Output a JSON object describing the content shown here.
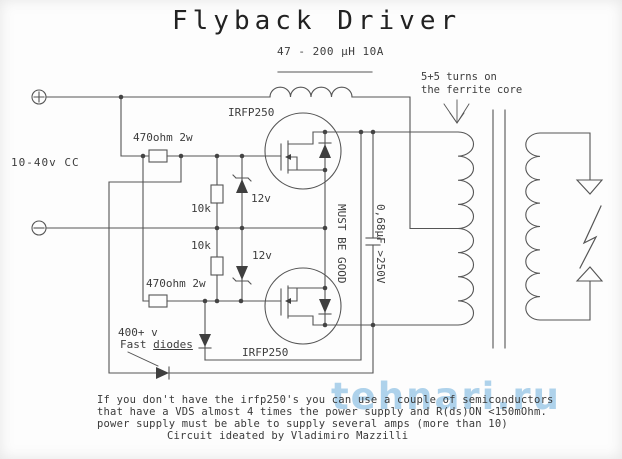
{
  "title": "Flyback Driver",
  "schematic": {
    "inductor_label": "47 - 200 µH 10A",
    "turns_note": {
      "line1": "5+5 turns on",
      "line2": "the ferrite core"
    },
    "supply_label": "10-40v CC",
    "gate_resistor_top": "470ohm 2w",
    "gate_resistor_bottom": "470ohm 2w",
    "pulldown_resistor_top": "10k",
    "pulldown_resistor_bottom": "10k",
    "zener_top": "12v",
    "zener_bottom": "12v",
    "mosfet_top": "IRFP250",
    "mosfet_bottom": "IRFP250",
    "capacitor_note": {
      "line1": "0,68µF >250V",
      "line2": "MUST BE GOOD"
    },
    "fast_diode_note": {
      "line1": "400+ v",
      "line2_word1": "Fast ",
      "line2_word2": "diodes"
    }
  },
  "footer": {
    "line1": "If you don't have the irfp250's you can use a couple of semiconductors",
    "line2": "that have a VDS almost 4 times the power supply and R(ds)ON <150mOhm.",
    "line3": "power supply must be able to supply several amps (more than 10)",
    "line4": "Circuit ideated by Vladimiro Mazzilli"
  },
  "watermark": "tehnari.ru",
  "colors": {
    "line": "#555555",
    "text": "#3d3d3d",
    "watermark": "#6fb0dd",
    "background": "#fdfdfd"
  }
}
